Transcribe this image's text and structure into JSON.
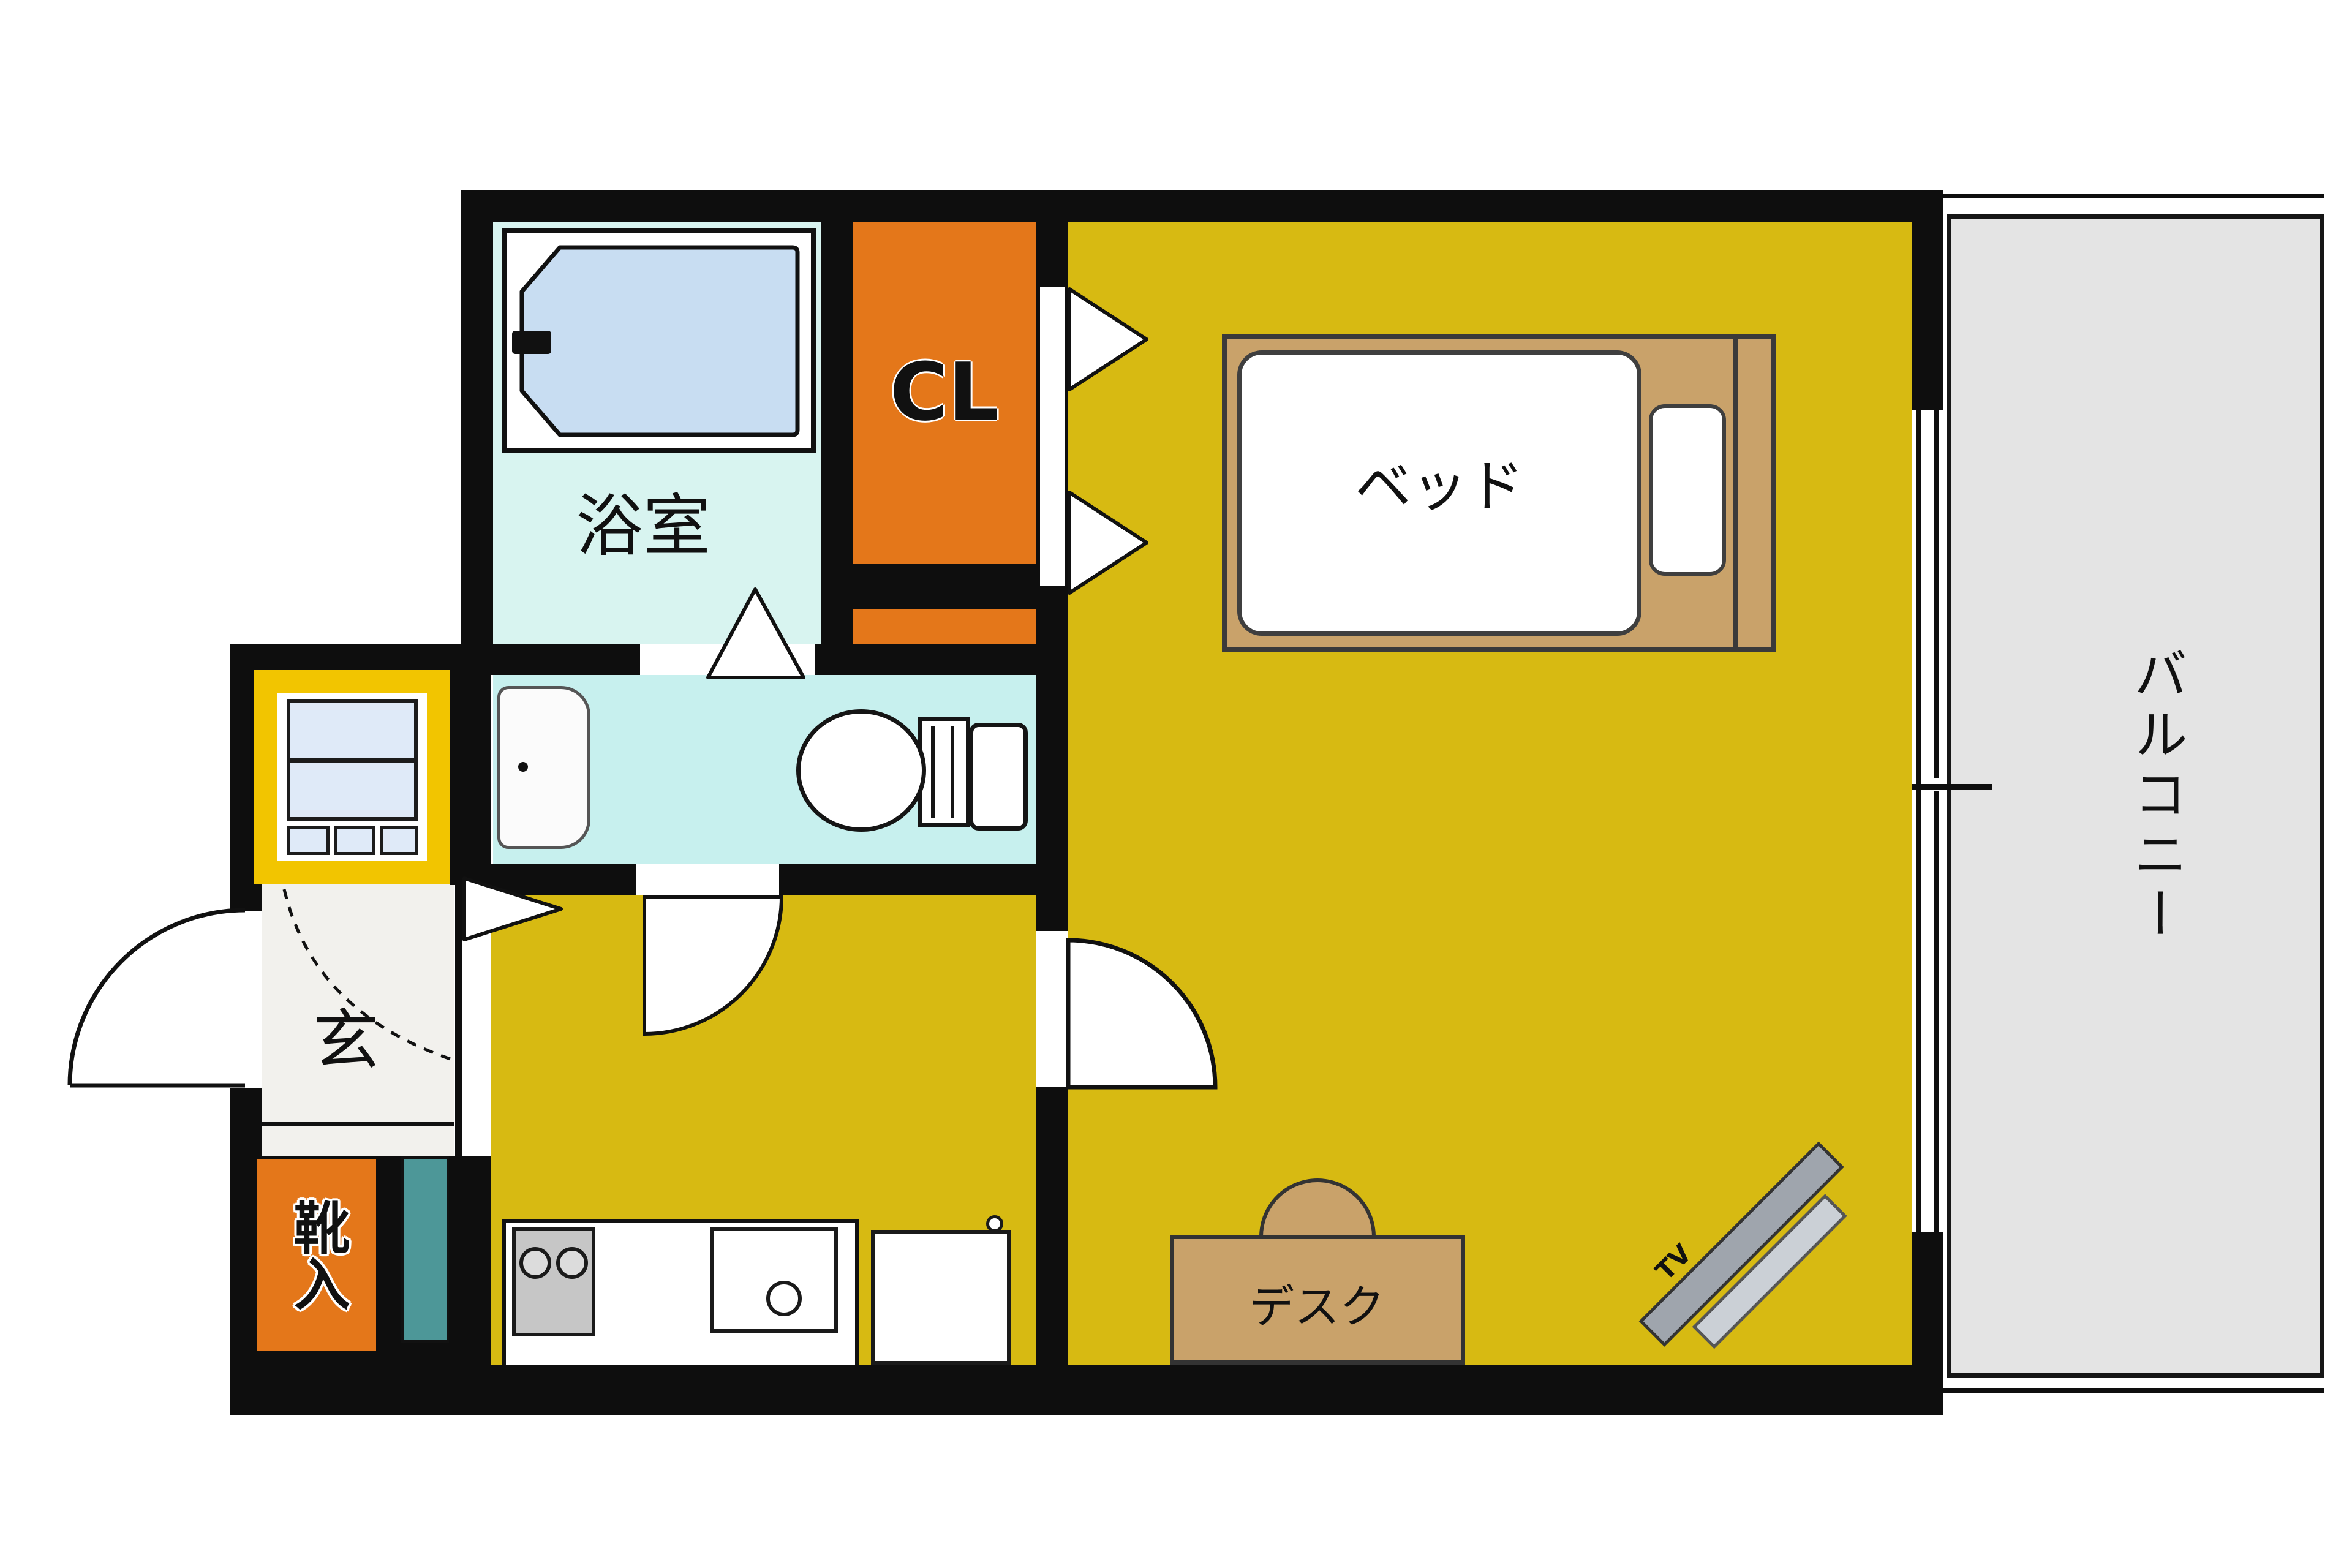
{
  "labels": {
    "bathroom": "浴室",
    "closet": "CL",
    "bed": "ベッド",
    "desk": "デスク",
    "tv": "TV",
    "entrance": "玄",
    "shoe_storage": "靴入",
    "balcony": "バルコニー"
  },
  "colors": {
    "wall": "#0e0e0e",
    "main_yellow": "#d7ba12",
    "bright_yellow": "#f2c500",
    "closet_orange": "#e4771a",
    "bathroom_cyan": "#d8f4f0",
    "washroom_cyan": "#c7f0ee",
    "tub_blue": "#c8ddf2",
    "washer_blue": "#dfeaf8",
    "furniture_tan": "#c9a26a",
    "balcony_gray": "#e4e4e4",
    "teal": "#4d9798",
    "genkan_white": "#f2f1ed",
    "stove_gray": "#c6c6c6",
    "tv_gray_dark": "#9fa5ad",
    "tv_gray_light": "#cbd0d6"
  }
}
